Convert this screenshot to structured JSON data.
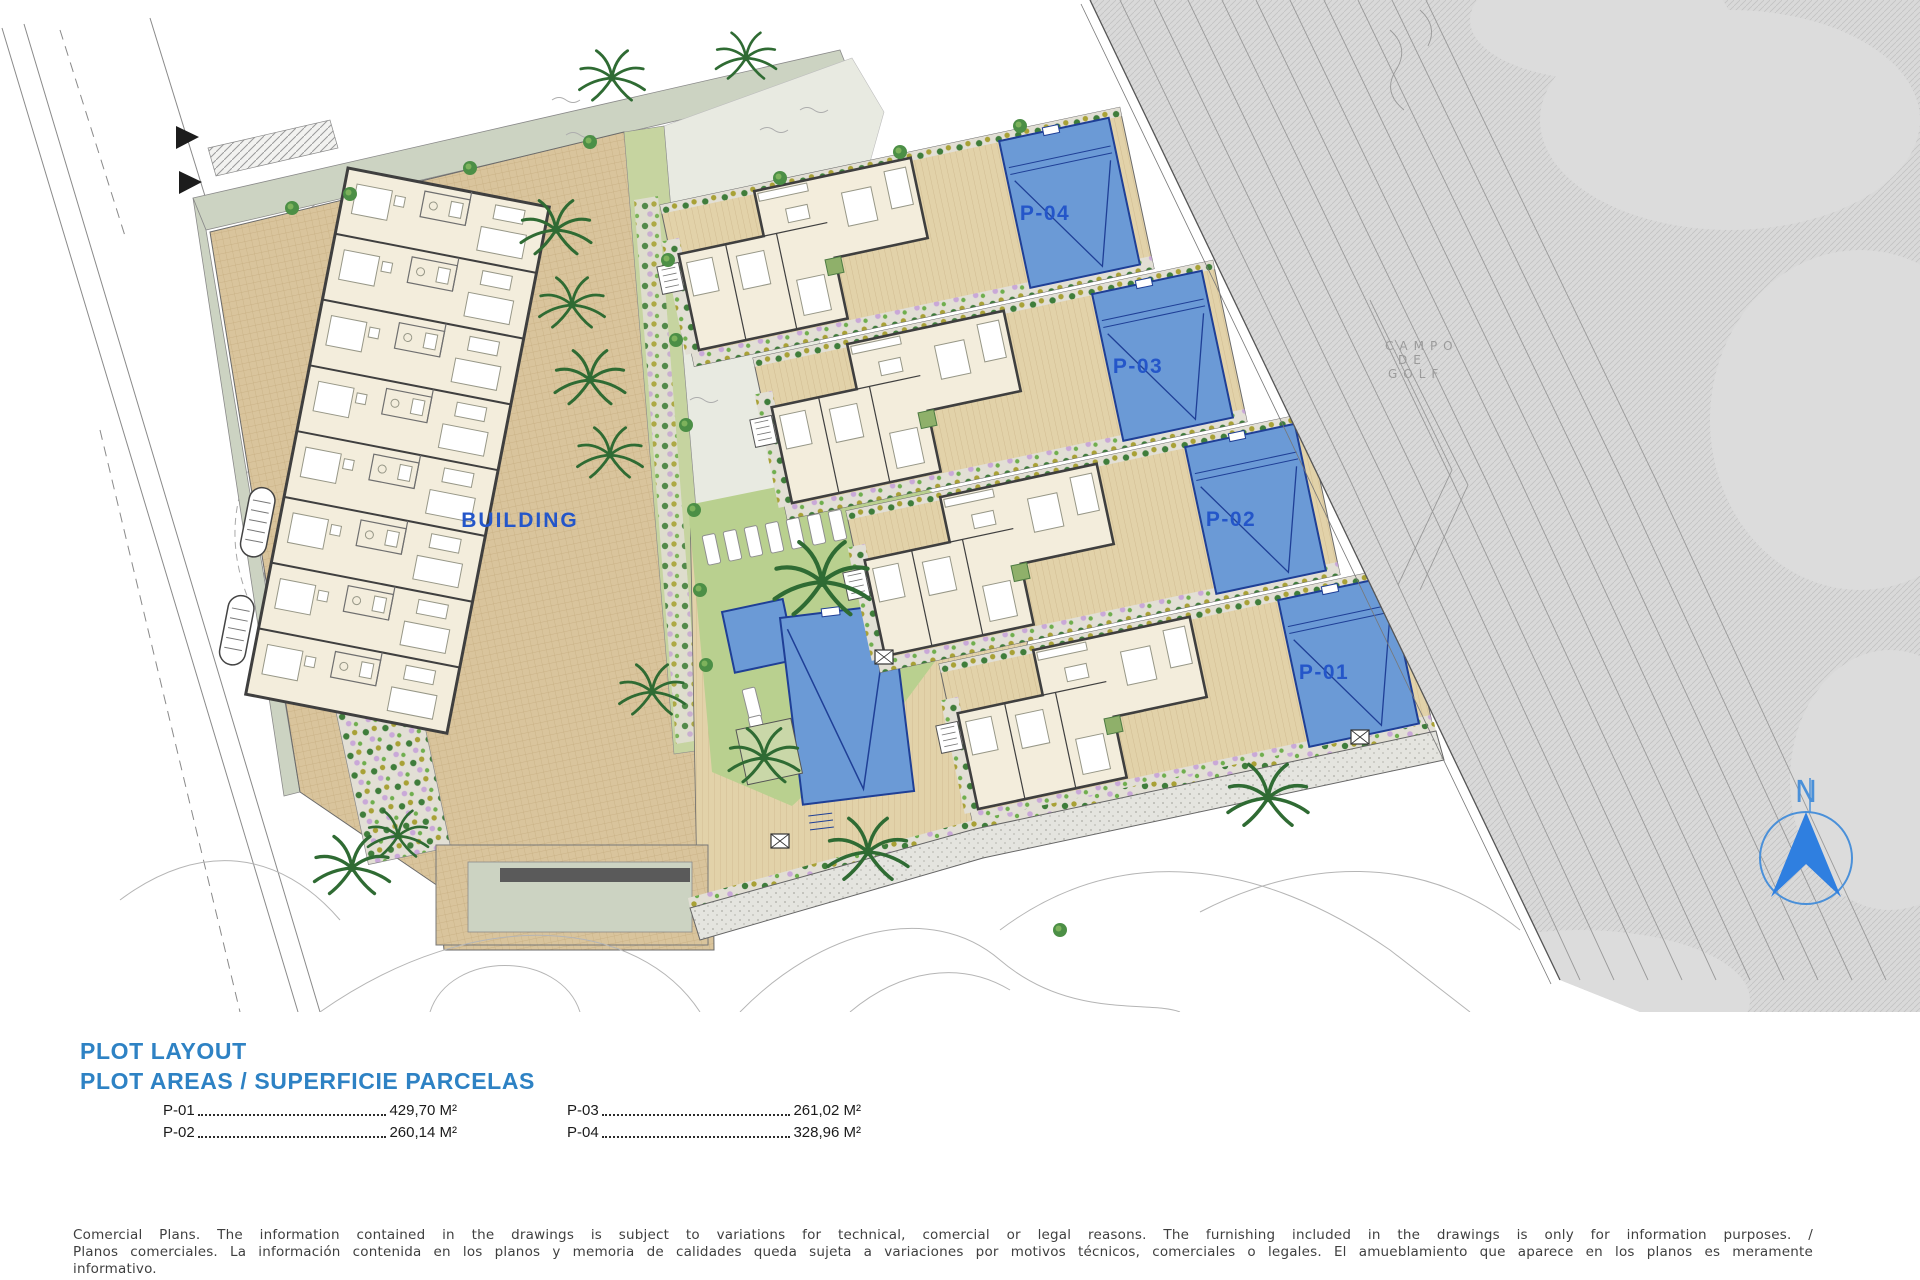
{
  "plan": {
    "building_label": "BUILDING",
    "plots": [
      {
        "label": "P-04"
      },
      {
        "label": "P-03"
      },
      {
        "label": "P-02"
      },
      {
        "label": "P-01"
      }
    ],
    "golf": {
      "line1": "CAMPO",
      "line2": "DE",
      "line3": "GOLF"
    },
    "compass_label": "N"
  },
  "legend": {
    "title": "PLOT LAYOUT",
    "subtitle": "PLOT AREAS / SUPERFICIE PARCELAS",
    "areas": [
      {
        "label": "P-01",
        "value": "429,70 M²"
      },
      {
        "label": "P-02",
        "value": "260,14 M²"
      },
      {
        "label": "P-03",
        "value": "261,02 M²"
      },
      {
        "label": "P-04",
        "value": "328,96 M²"
      }
    ]
  },
  "disclaimer": {
    "line1": "Comercial Plans. The information contained in the drawings is subject to variations for technical, comercial or legal reasons. The furnishing included in the drawings is only for information purposes. /",
    "line2": "Planos comerciales. La información contenida en los planos y memoria de calidades queda sujeta a variaciones por motivos técnicos, comerciales o legales. El amueblamiento que aparece en los planos es meramente",
    "line3": "informativo."
  },
  "colors": {
    "label_blue": "#2456c9",
    "title_blue": "#2e82c4",
    "pool_blue": "#6b9ad6",
    "pool_line": "#1f3f96",
    "paving_tan": "#d9c49c",
    "golf_gray": "#d9d9d9",
    "lawn_green": "#b9d08f",
    "road_sage": "#ccd3c2"
  }
}
